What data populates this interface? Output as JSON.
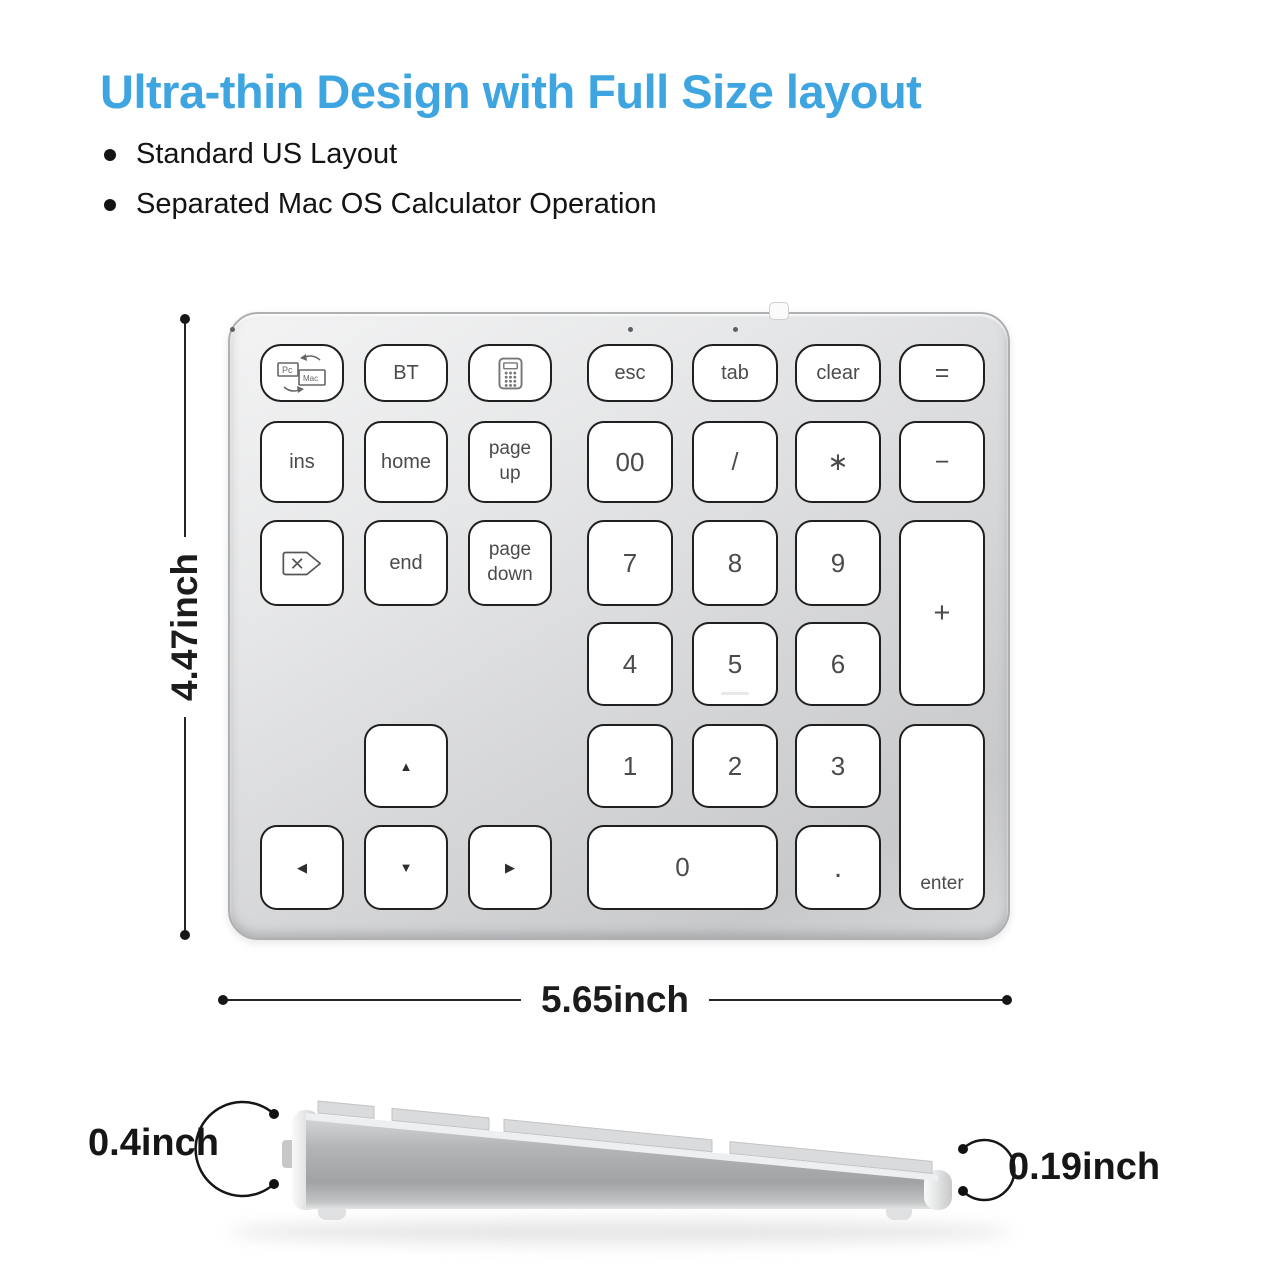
{
  "header": {
    "title": "Ultra-thin Design with Full Size layout",
    "bullets": [
      "Standard US Layout",
      "Separated Mac OS Calculator Operation"
    ]
  },
  "colors": {
    "accent_blue": "#3fa5e0",
    "key_border": "#202020",
    "body_silver": "#d6d7d9",
    "annotation_black": "#161616"
  },
  "dimensions": {
    "height_label": "4.47inch",
    "width_label": "5.65inch",
    "front_thickness_label": "0.4inch",
    "rear_thickness_label": "0.19inch"
  },
  "keyboard": {
    "status_led_count": 3,
    "keys": [
      {
        "name": "pc-mac-switch",
        "icon": "pc-mac-switch-icon",
        "col": 1,
        "row": 1
      },
      {
        "name": "bt",
        "label": "BT",
        "col": 2,
        "row": 1
      },
      {
        "name": "calculator",
        "icon": "calculator-icon",
        "col": 3,
        "row": 1
      },
      {
        "name": "esc",
        "label": "esc",
        "col": 4,
        "row": 1
      },
      {
        "name": "tab",
        "label": "tab",
        "col": 5,
        "row": 1
      },
      {
        "name": "clear",
        "label": "clear",
        "col": 6,
        "row": 1
      },
      {
        "name": "equals",
        "label": "=",
        "col": 7,
        "row": 1,
        "cls": "sym"
      },
      {
        "name": "ins",
        "label": "ins",
        "col": 1,
        "row": 2
      },
      {
        "name": "home",
        "label": "home",
        "col": 2,
        "row": 2
      },
      {
        "name": "page-up",
        "label": "page up",
        "col": 3,
        "row": 2,
        "cls": "two-line"
      },
      {
        "name": "double-zero",
        "label": "00",
        "col": 4,
        "row": 2,
        "cls": "num"
      },
      {
        "name": "divide",
        "label": "/",
        "col": 5,
        "row": 2,
        "cls": "sym"
      },
      {
        "name": "multiply",
        "label": "∗",
        "col": 6,
        "row": 2,
        "cls": "sym"
      },
      {
        "name": "minus",
        "label": "−",
        "col": 7,
        "row": 2,
        "cls": "sym"
      },
      {
        "name": "delete-forward",
        "icon": "delete-key-icon",
        "col": 1,
        "row": 3
      },
      {
        "name": "end",
        "label": "end",
        "col": 2,
        "row": 3
      },
      {
        "name": "page-down",
        "label": "page down",
        "col": 3,
        "row": 3,
        "cls": "two-line"
      },
      {
        "name": "7",
        "label": "7",
        "col": 4,
        "row": 3,
        "cls": "num"
      },
      {
        "name": "8",
        "label": "8",
        "col": 5,
        "row": 3,
        "cls": "num"
      },
      {
        "name": "9",
        "label": "9",
        "col": 6,
        "row": 3,
        "cls": "num"
      },
      {
        "name": "plus",
        "label": "+",
        "col": 7,
        "row": 3,
        "rowspan": 2,
        "cls": "sym plus"
      },
      {
        "name": "4",
        "label": "4",
        "col": 4,
        "row": 4,
        "cls": "num"
      },
      {
        "name": "5",
        "label": "5",
        "col": 5,
        "row": 4,
        "cls": "num",
        "bump": true
      },
      {
        "name": "6",
        "label": "6",
        "col": 6,
        "row": 4,
        "cls": "num"
      },
      {
        "name": "arrow-up",
        "label": "▲",
        "col": 2,
        "row": 5,
        "cls": "arrow"
      },
      {
        "name": "1",
        "label": "1",
        "col": 4,
        "row": 5,
        "cls": "num"
      },
      {
        "name": "2",
        "label": "2",
        "col": 5,
        "row": 5,
        "cls": "num"
      },
      {
        "name": "3",
        "label": "3",
        "col": 6,
        "row": 5,
        "cls": "num"
      },
      {
        "name": "enter",
        "label": "enter",
        "col": 7,
        "row": 5,
        "rowspan": 2,
        "cls": "enter"
      },
      {
        "name": "arrow-left",
        "label": "◀",
        "col": 1,
        "row": 6,
        "cls": "arrow"
      },
      {
        "name": "arrow-down",
        "label": "▼",
        "col": 2,
        "row": 6,
        "cls": "arrow"
      },
      {
        "name": "arrow-right",
        "label": "▶",
        "col": 3,
        "row": 6,
        "cls": "arrow"
      },
      {
        "name": "0",
        "label": "0",
        "col": 4,
        "row": 6,
        "colspan": 2,
        "cls": "num"
      },
      {
        "name": "decimal",
        "label": ".",
        "col": 6,
        "row": 6,
        "cls": "num dot"
      }
    ]
  }
}
